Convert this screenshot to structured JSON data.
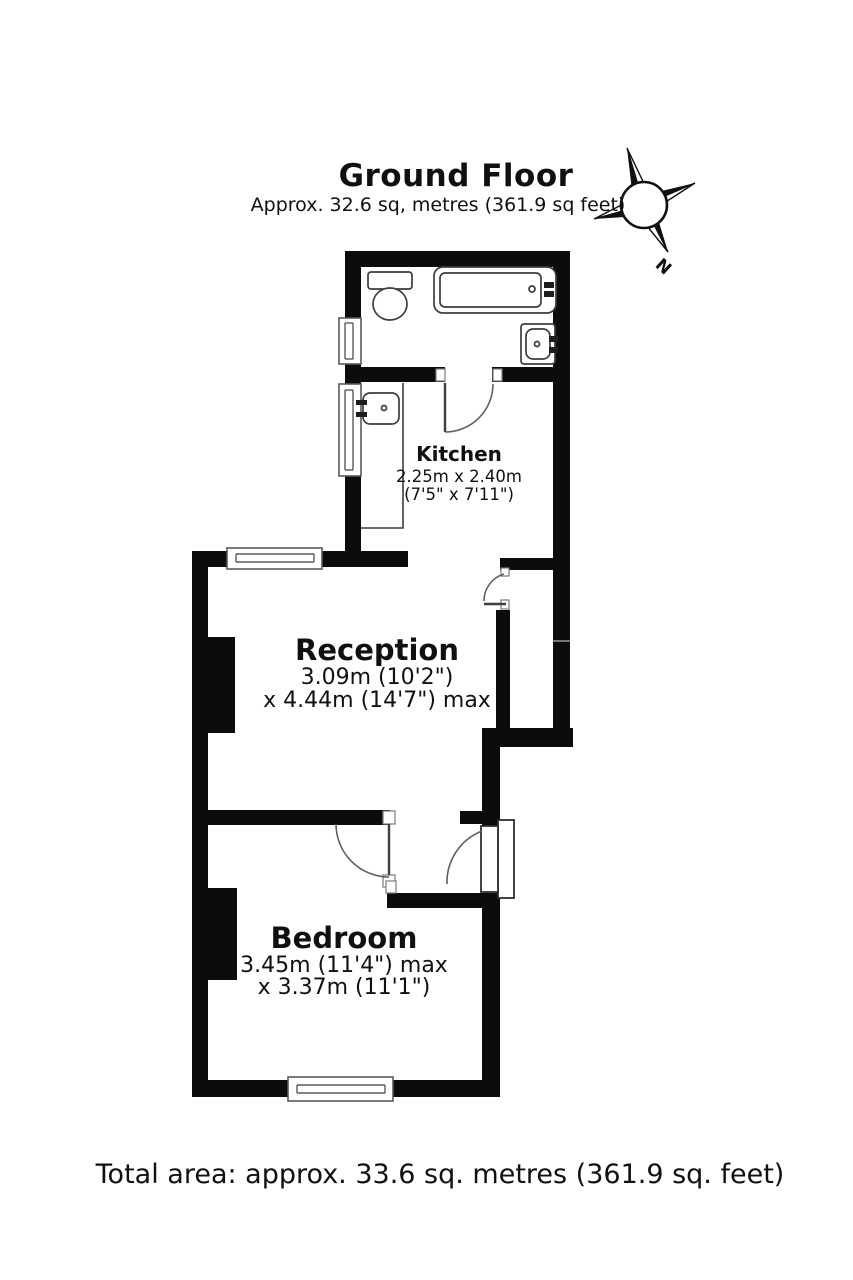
{
  "header": {
    "title": "Ground Floor",
    "subtitle": "Approx. 32.6 sq, metres (361.9 sq feet)"
  },
  "compass": {
    "north": "N"
  },
  "rooms": {
    "kitchen": {
      "name": "Kitchen",
      "dims1": "2.25m x 2.40m",
      "dims2": "(7'5\" x 7'11\")"
    },
    "reception": {
      "name": "Reception",
      "dims1": "3.09m (10'2\")",
      "dims2": "x 4.44m (14'7\") max"
    },
    "bedroom": {
      "name": "Bedroom",
      "dims1": "3.45m (11'4\") max",
      "dims2": "x 3.37m (11'1\")"
    }
  },
  "footer": {
    "total_area": "Total area: approx. 33.6 sq. metres (361.9 sq. feet)"
  }
}
